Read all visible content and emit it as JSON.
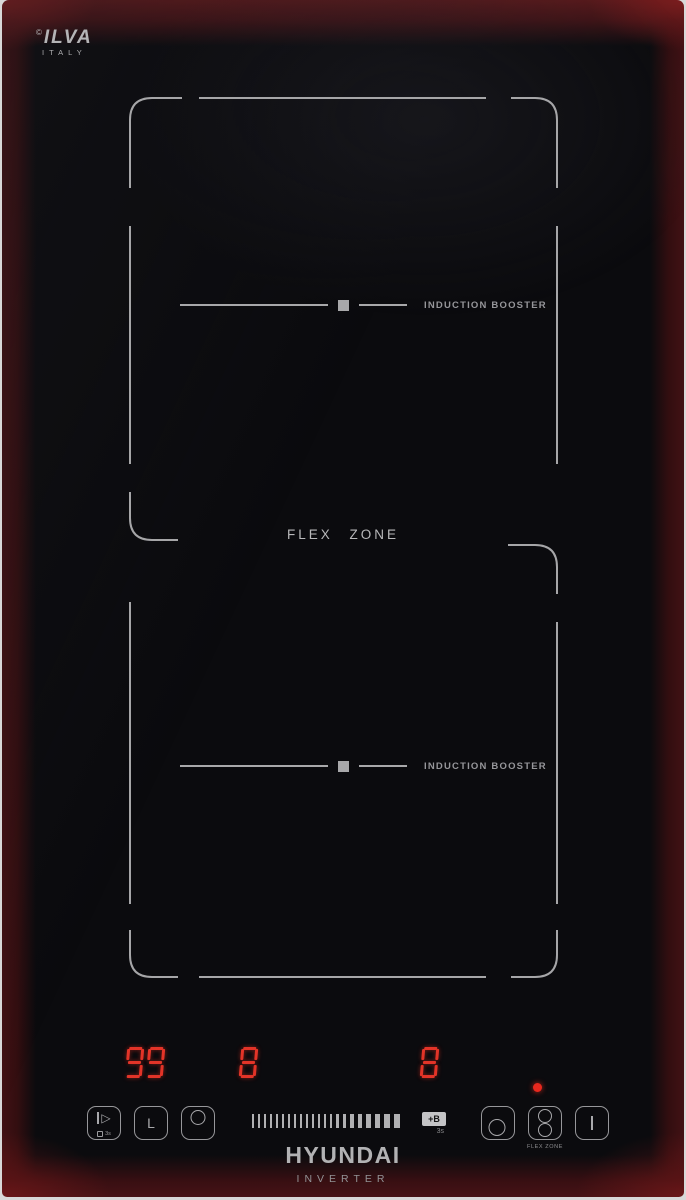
{
  "brand": {
    "mark": "©",
    "logo": "ILVA",
    "country": "ITALY",
    "maker": "HYUNDAI",
    "maker_sub": "INVERTER"
  },
  "zones": {
    "flex_label": "FLEX ZONE",
    "upper": {
      "booster_label": "INDUCTION BOOSTER"
    },
    "lower": {
      "booster_label": "INDUCTION BOOSTER"
    }
  },
  "displays": {
    "timer": "99",
    "upper_power": "8",
    "lower_power": "8"
  },
  "controls": {
    "pause_lock_key": {
      "hold_hint": "3s",
      "icon": "pause-lock-icon"
    },
    "timer_key": {
      "glyph": "L",
      "icon": "timer-clock-icon"
    },
    "upper_zone_key": {
      "icon": "upper-zone-select-icon"
    },
    "lower_zone_key": {
      "icon": "lower-zone-select-icon"
    },
    "flex_zone_key": {
      "label": "FLEX ZONE",
      "icon": "flex-zone-icon"
    },
    "power_key": {
      "icon": "power-on-off-icon"
    },
    "booster_key": {
      "label": "+B",
      "hold_hint": "3s"
    },
    "slider": {
      "ticks": [
        2,
        2,
        2,
        2,
        2,
        2,
        2,
        2,
        2,
        2,
        2,
        2,
        2,
        2,
        3,
        3,
        4,
        4,
        5,
        5,
        6,
        6
      ]
    }
  },
  "colors": {
    "segment_red": "#e23428",
    "led_red": "#e8281e",
    "outline_gray": "#a6a6a8",
    "edge_red": "#4a1315"
  }
}
